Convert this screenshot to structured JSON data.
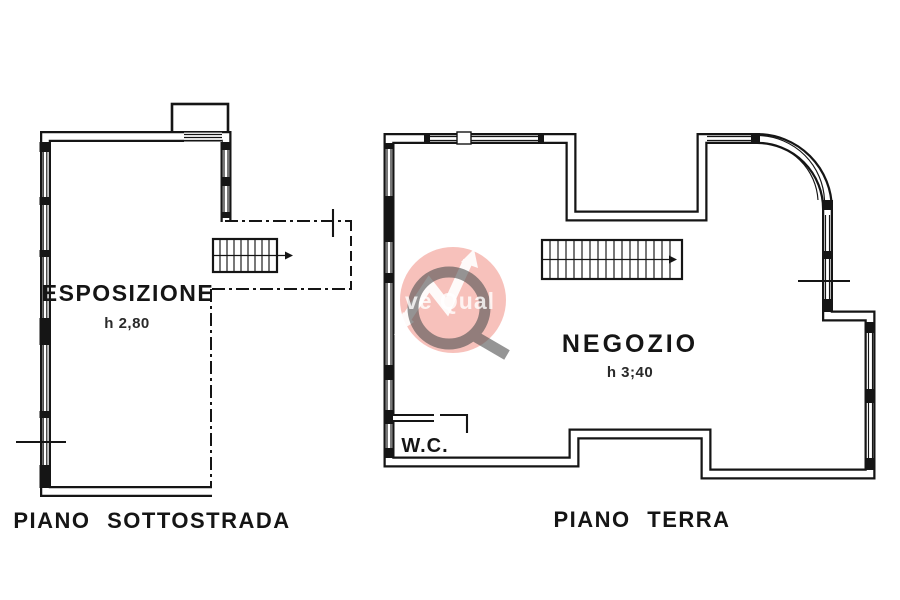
{
  "page": {
    "background": "#ffffff",
    "ink_color": "#151515"
  },
  "plans": {
    "sottostrada": {
      "room_label": "ESPOSIZIONE",
      "room_height": "h 2,80",
      "floor_label": "PIANO SOTTOSTRADA"
    },
    "terra": {
      "room_label": "NEGOZIO",
      "room_height": "h 3;40",
      "wc_label": "W.C.",
      "floor_label": "PIANO TERRA"
    }
  },
  "watermark": {
    "text": "ve Qual",
    "circle_color": "#f08478",
    "q_color": "#555555",
    "arrow_color": "#ffffff"
  }
}
